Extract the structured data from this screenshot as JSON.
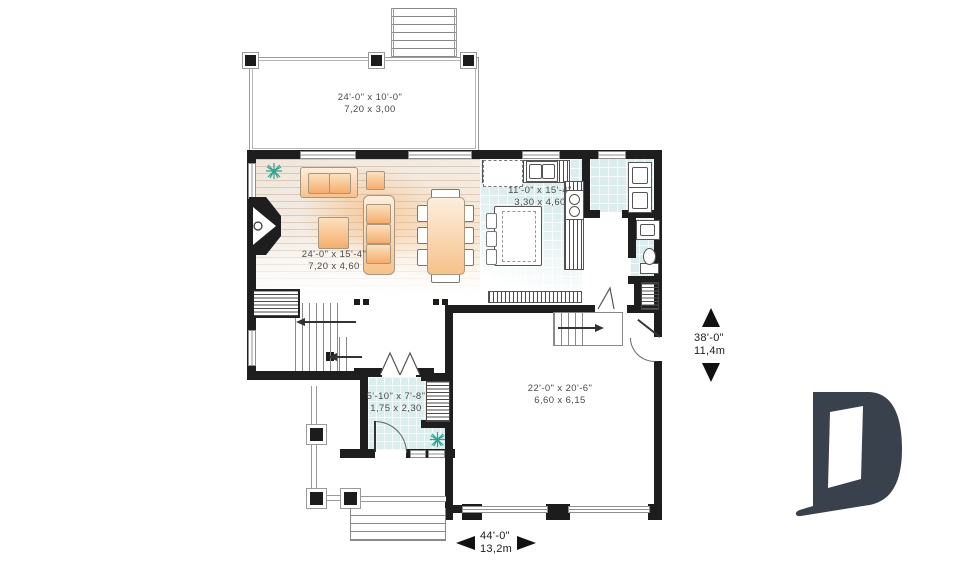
{
  "plan": {
    "rooms": [
      {
        "id": "deck",
        "imperial": "24'-0\" x 10'-0\"",
        "metric": "7,20 x 3,00"
      },
      {
        "id": "living",
        "imperial": "24'-0\" x 15'-4\"",
        "metric": "7,20 x 4,60"
      },
      {
        "id": "kitchen",
        "imperial": "11'-0\" x 15'-4\"",
        "metric": "3,30 x 4,60"
      },
      {
        "id": "foyer",
        "imperial": "5'-10\" x 7'-8\"",
        "metric": "1,75 x 2,30"
      },
      {
        "id": "garage",
        "imperial": "22'-0\" x 20'-6\"",
        "metric": "6,60 x 6,15"
      }
    ],
    "dimensions": {
      "width": {
        "imperial": "44'-0\"",
        "metric": "13,2m"
      },
      "depth": {
        "imperial": "38'-0\"",
        "metric": "11,4m"
      }
    },
    "branding": {
      "logo_letter": "D",
      "logo_color": "#39424c"
    },
    "colors": {
      "wall": "#1e1e1e",
      "furniture": "#f7c28b",
      "tile": "#dcedee",
      "wood": "#efe5da",
      "plant": "#2fa190"
    }
  }
}
